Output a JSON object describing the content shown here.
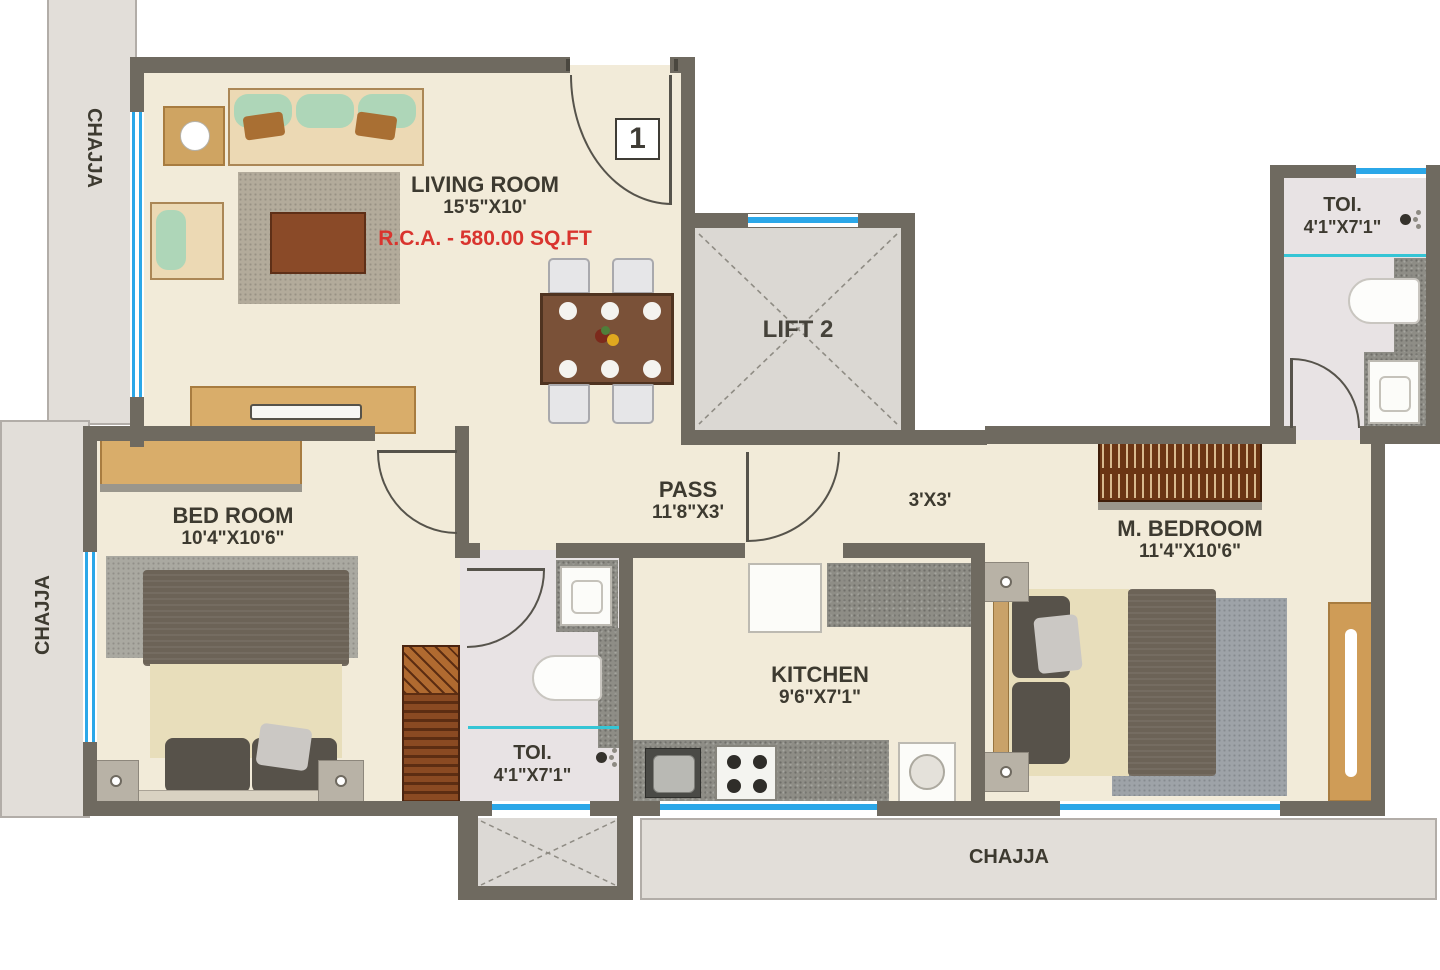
{
  "colors": {
    "wall": "#6f6a60",
    "window_blue": "#2ba7e8",
    "partition_cyan": "#35c5d5",
    "area_text_red": "#d9342e",
    "floor_cream": "#f2ebd9",
    "toilet_floor": "#e8e3e4",
    "chajja_gray": "#e2ded9"
  },
  "plan": {
    "entrance_door_label": "1",
    "living": {
      "label": "LIVING ROOM",
      "dims": "15'5\"X10'"
    },
    "rca_label": "R.C.A. - 580.00 SQ.FT",
    "lift_label": "LIFT 2",
    "toilet_top": {
      "label": "TOI.",
      "dims": "4'1\"X7'1\""
    },
    "pass": {
      "label": "PASS",
      "dims": "11'8\"X3'"
    },
    "lobby_dims": "3'X3'",
    "master_bedroom": {
      "label": "M. BEDROOM",
      "dims": "11'4\"X10'6\""
    },
    "bedroom": {
      "label": "BED ROOM",
      "dims": "10'4\"X10'6\""
    },
    "toilet_mid": {
      "label": "TOI.",
      "dims": "4'1\"X7'1\""
    },
    "kitchen": {
      "label": "KITCHEN",
      "dims": "9'6\"X7'1\""
    },
    "chajja_top_left": "CHAJJA",
    "chajja_left": "CHAJJA",
    "chajja_bottom": "CHAJJA"
  }
}
